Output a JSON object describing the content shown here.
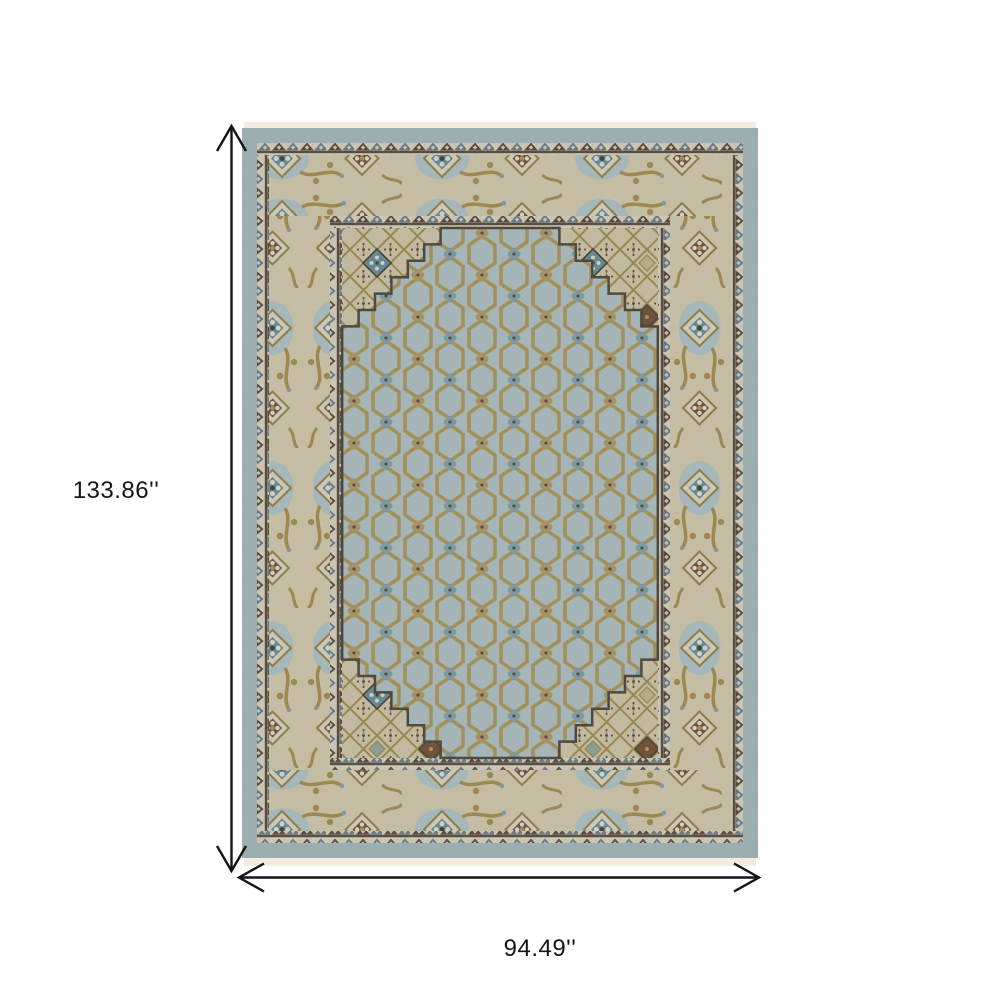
{
  "dimension_labels": {
    "height": "133.86''",
    "width": "94.49''"
  },
  "rug_palette": {
    "outer_band": "#a7bfc2",
    "guard_background": "#e4ddc6",
    "guard_triangle_brown": "#4c3a2b",
    "guard_triangle_slate": "#657480",
    "border_cream": "#ddd2b2",
    "border_cloud_blue": "#b5cbcd",
    "field_beige": "#d9cfad",
    "medallion_blue": "#b4c9cb",
    "lattice_gold": "#b1964e",
    "rosette_teal": "#5e8e97",
    "rosette_brown": "#6d4526",
    "rosette_slate": "#7fa3ab",
    "outline_dark": "#40372b",
    "fringe": "#f1ecdf",
    "dimension_line": "#141414"
  }
}
